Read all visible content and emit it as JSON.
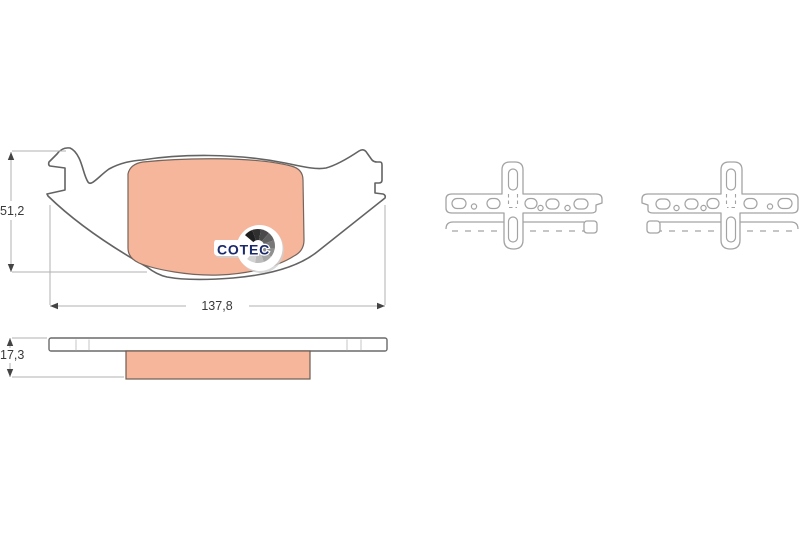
{
  "title": "Brake pad set technical drawing",
  "dimensions": {
    "height": "51,2",
    "width": "137,8",
    "thickness": "17,3"
  },
  "logo": {
    "text": "COTEC"
  },
  "colors": {
    "friction": "#f6b69c",
    "outline": "#636363",
    "accessory_outline": "#a3a3a3",
    "dimension_line": "#b0b0b0",
    "dimension_text": "#3a3a3a",
    "logo_navy": "#1b2a6b",
    "background": "#ffffff"
  }
}
